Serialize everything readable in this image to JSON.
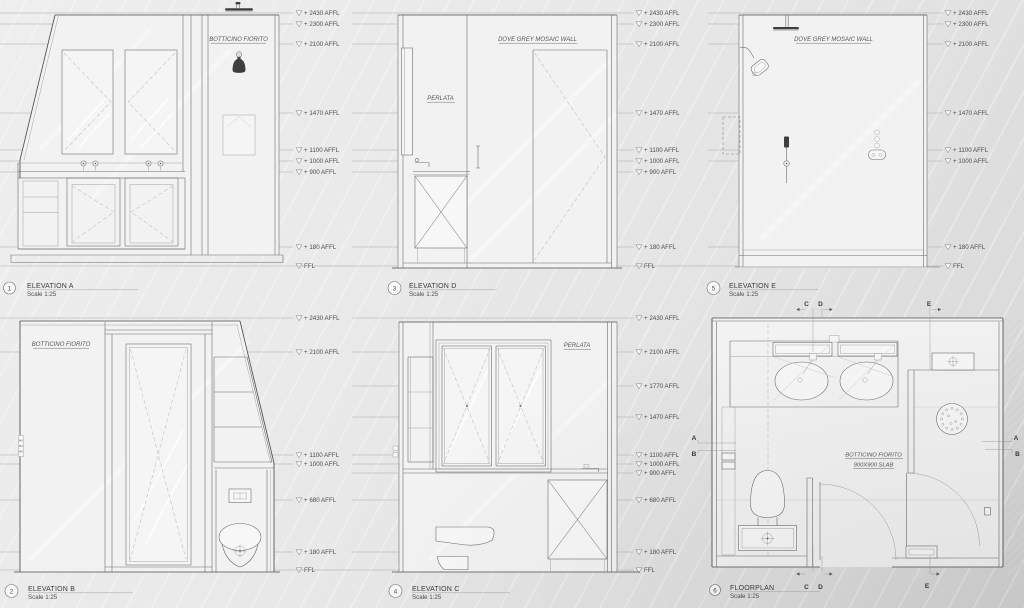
{
  "panels": {
    "a": {
      "num": "1",
      "title": "ELEVATION A",
      "scale": "Scale 1:25",
      "material_label": "BOTTICINO FIORITO",
      "dims": [
        "+ 2430 AFFL",
        "+ 2300 AFFL",
        "+ 2100 AFFL",
        "+ 1470 AFFL",
        "+ 1100 AFFL",
        "+ 1000 AFFL",
        "+ 900 AFFL",
        "+ 180 AFFL",
        "FFL"
      ]
    },
    "d": {
      "num": "3",
      "title": "ELEVATION D",
      "scale": "Scale 1:25",
      "wall_label": "DOVE GREY MOSAIC WALL",
      "material_label": "PERLATA",
      "dims": [
        "+ 2430 AFFL",
        "+ 2300 AFFL",
        "+ 2100 AFFL",
        "+ 1470 AFFL",
        "+ 1100 AFFL",
        "+ 1000 AFFL",
        "+ 900 AFFL",
        "+ 180 AFFL",
        "FFL"
      ]
    },
    "e": {
      "num": "5",
      "title": "ELEVATION E",
      "scale": "Scale 1:25",
      "wall_label": "DOVE GREY MOSAIC WALL",
      "dims": [
        "+ 2430 AFFL",
        "+ 2300 AFFL",
        "+ 2100 AFFL",
        "+ 1470 AFFL",
        "+ 1100 AFFL",
        "+ 1000 AFFL",
        "+ 180 AFFL",
        "FFL"
      ]
    },
    "b": {
      "num": "2",
      "title": "ELEVATION B",
      "scale": "Scale 1:25",
      "material_label": "BOTTICINO FIORITO",
      "dims": [
        "+ 2430 AFFL",
        "+ 2100 AFFL",
        "+ 1100 AFFL",
        "+ 1000 AFFL",
        "+ 680 AFFL",
        "+ 180 AFFL",
        "FFL"
      ]
    },
    "c": {
      "num": "4",
      "title": "ELEVATION C",
      "scale": "Scale 1:25",
      "material_label": "PERLATA",
      "dims": [
        "+ 2430 AFFL",
        "+ 2100 AFFL",
        "+ 1770 AFFL",
        "+ 1470 AFFL",
        "+ 1100 AFFL",
        "+ 1000 AFFL",
        "+ 900 AFFL",
        "+ 680 AFFL",
        "+ 180 AFFL",
        "FFL"
      ]
    },
    "plan": {
      "num": "6",
      "title": "FLOORPLAN",
      "scale": "Scale 1:25",
      "material_label_line1": "BOTTICINO FIORITO",
      "material_label_line2": "900X900 SLAB",
      "markers": {
        "c_top": "C",
        "d_top": "D",
        "e_top": "E",
        "c_bottom": "C",
        "d_bottom": "D",
        "e_bottom": "E",
        "a_left": "A",
        "b_left": "B",
        "a_right": "A",
        "b_right": "B"
      }
    }
  }
}
